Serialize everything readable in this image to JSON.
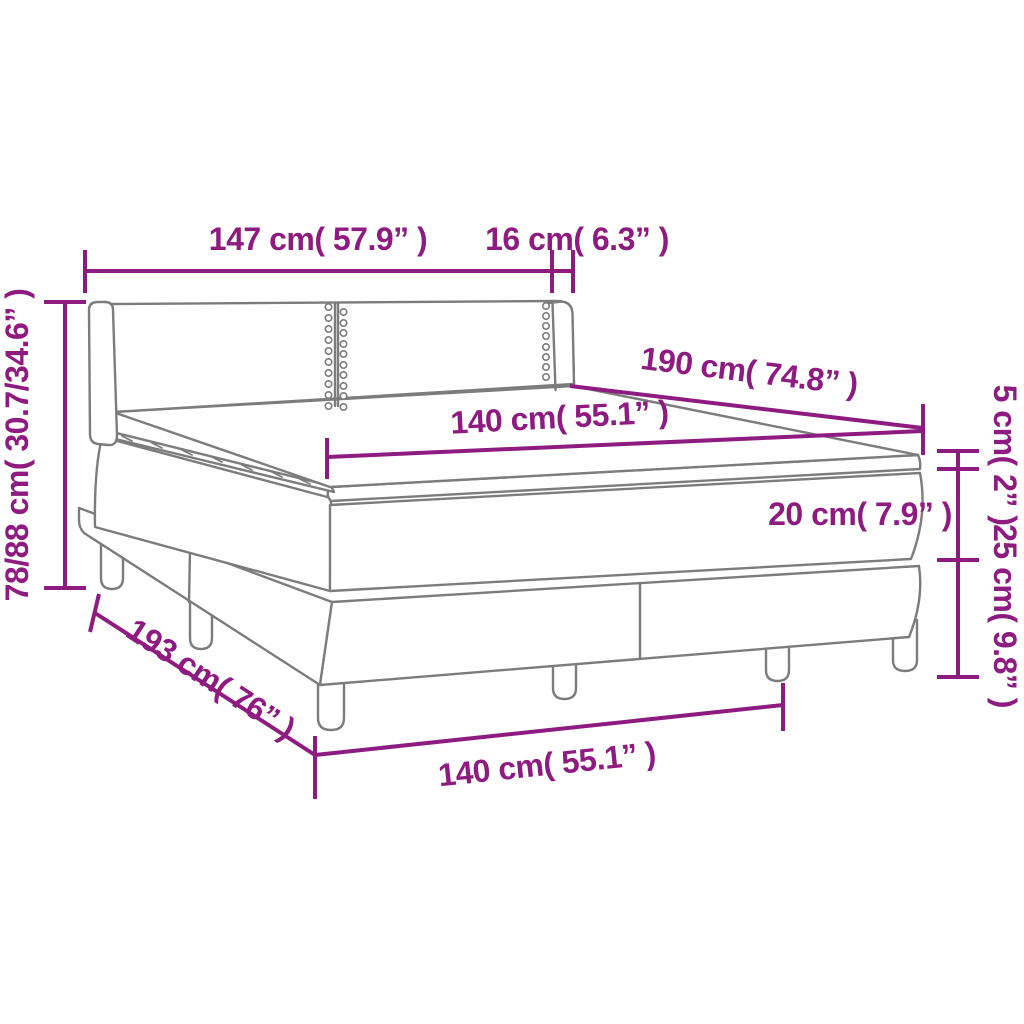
{
  "diagram": {
    "subject": "box-spring-bed-dimension-diagram",
    "colors": {
      "dimension_color": "#8E1B80",
      "outline_color": "#7C7C7C",
      "background": "#FFFFFF"
    },
    "dimensions": [
      {
        "id": "headboard-width",
        "cm": "147",
        "inch": "57.9",
        "text": "147 cm( 57.9” )"
      },
      {
        "id": "wing-depth",
        "cm": "16",
        "inch": "6.3",
        "text": "16 cm( 6.3” )"
      },
      {
        "id": "height-range",
        "cm": "78/88",
        "inch": "30.7/34.6",
        "text": "78/88 cm( 30.7/34.6” )"
      },
      {
        "id": "bed-length",
        "cm": "190",
        "inch": "74.8",
        "text": "190 cm( 74.8” )"
      },
      {
        "id": "mattress-width",
        "cm": "140",
        "inch": "55.1",
        "text": "140 cm( 55.1” )"
      },
      {
        "id": "topper-height",
        "cm": "5",
        "inch": "2",
        "text": "5 cm( 2” )"
      },
      {
        "id": "mattress-height",
        "cm": "20",
        "inch": "7.9",
        "text": "20 cm( 7.9” )"
      },
      {
        "id": "base-height",
        "cm": "25",
        "inch": "9.8",
        "text": "25 cm( 9.8” )"
      },
      {
        "id": "total-length",
        "cm": "193",
        "inch": "76",
        "text": "193 cm( 76” )"
      },
      {
        "id": "bottom-width",
        "cm": "140",
        "inch": "55.1",
        "text": "140 cm( 55.1” )"
      }
    ]
  }
}
